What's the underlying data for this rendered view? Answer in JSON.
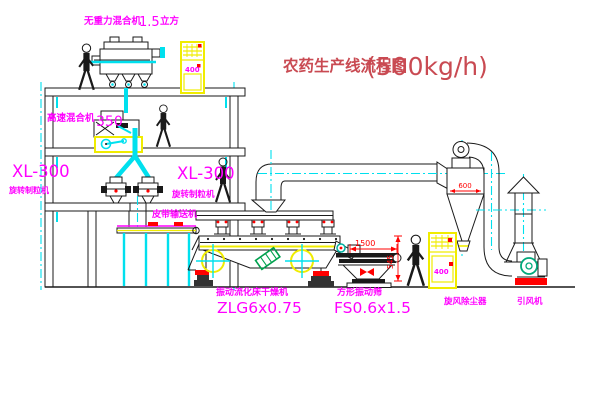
{
  "title": {
    "text": "农药生产线流程图",
    "capacity": "(500kg/h)"
  },
  "equipment": {
    "gravity_mixer": {
      "name": "无重力混合机",
      "size": "1.5",
      "unit": "立方"
    },
    "high_speed_mixer": {
      "name": "高速混合机",
      "size": "350"
    },
    "granulator_left": {
      "model": "XL-300",
      "type": "旋转制粒机"
    },
    "granulator_right": {
      "model": "XL-300",
      "type": "旋转制粒机"
    },
    "belt_conveyor": {
      "name": "皮带输送机"
    },
    "dryer": {
      "name": "振动流化床干燥机",
      "model": "ZLG6x0.75"
    },
    "screen": {
      "name": "方形振动筛",
      "model": "FS0.6x1.5"
    },
    "cyclone": {
      "name": "旋风除尘器"
    },
    "fan": {
      "name": "引风机"
    }
  },
  "dimensions": {
    "cyclone_diameter": "600",
    "screen_length": "1500",
    "screen_height": "545"
  },
  "panels": {
    "top_cabinet": "400",
    "right_cabinet": "400"
  },
  "colors": {
    "label_magenta": "#ff00ff",
    "title_red": "#c94a52",
    "dim_red": "#ff0000",
    "centerline_cyan": "#00e0ee",
    "equipment_yellow": "#f0ec00",
    "fan_green": "#00a87a",
    "line_black": "#1a1a1a",
    "background": "#ffffff"
  }
}
